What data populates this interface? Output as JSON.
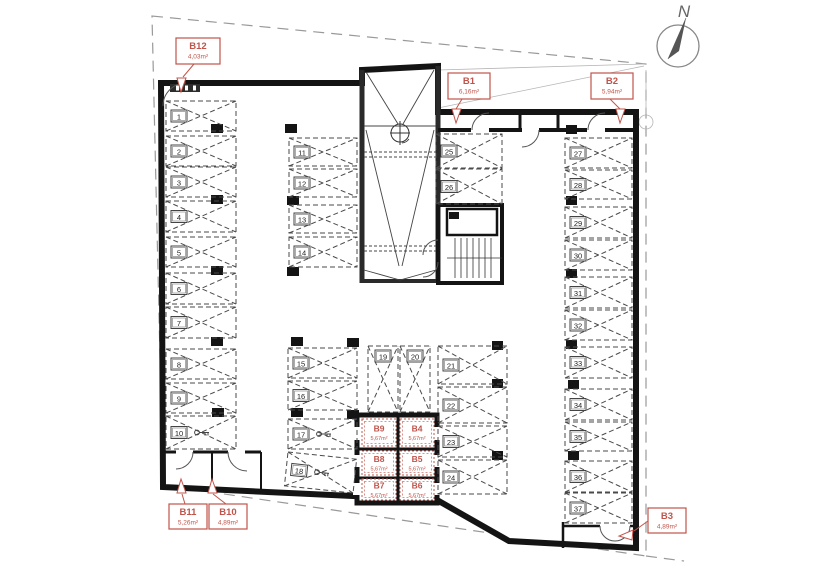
{
  "compass": {
    "label": "N"
  },
  "colors": {
    "accent_red": "#c0544b",
    "wall": "#141414",
    "line": "#4a4a4a",
    "boundary": "#999999"
  },
  "parking_spaces": [
    "1",
    "2",
    "3",
    "4",
    "5",
    "6",
    "7",
    "8",
    "9",
    "10",
    "11",
    "12",
    "13",
    "14",
    "15",
    "16",
    "17",
    "18",
    "19",
    "20",
    "21",
    "22",
    "23",
    "24",
    "25",
    "26",
    "27",
    "28",
    "29",
    "30",
    "31",
    "32",
    "33",
    "34",
    "35",
    "36",
    "37"
  ],
  "storage_rooms": [
    {
      "id": "B9",
      "area": "5,67m²"
    },
    {
      "id": "B4",
      "area": "5,67m²"
    },
    {
      "id": "B8",
      "area": "5,67m²"
    },
    {
      "id": "B5",
      "area": "5,67m²"
    },
    {
      "id": "B7",
      "area": "5,67m²"
    },
    {
      "id": "B6",
      "area": "5,67m²"
    }
  ],
  "callouts": [
    {
      "id": "B12",
      "area": "4,03m²"
    },
    {
      "id": "B1",
      "area": "6,16m²"
    },
    {
      "id": "B2",
      "area": "5,94m²"
    },
    {
      "id": "B11",
      "area": "5,26m²"
    },
    {
      "id": "B10",
      "area": "4,89m²"
    },
    {
      "id": "B3",
      "area": "4,89m²"
    }
  ]
}
